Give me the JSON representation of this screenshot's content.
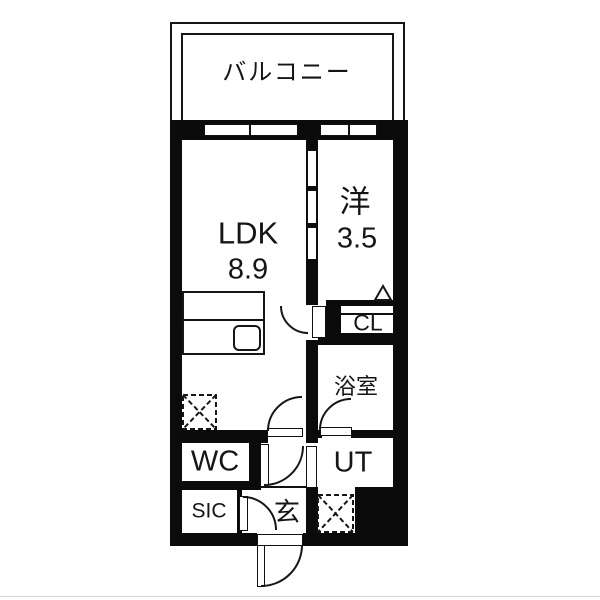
{
  "balcony": {
    "label": "バルコニー"
  },
  "rooms": {
    "ldk": {
      "label": "LDK",
      "size": "8.9"
    },
    "western_room": {
      "label": "洋",
      "size": "3.5"
    },
    "closet": {
      "label": "CL"
    },
    "bathroom": {
      "label": "浴室"
    },
    "toilet": {
      "label": "WC"
    },
    "utility": {
      "label": "UT"
    },
    "shoe_closet": {
      "label": "SIC"
    },
    "entrance": {
      "label": "玄"
    }
  },
  "marks": {
    "refrigerator_mark": "dashed-square-x",
    "washer_mark": "dashed-square-x",
    "closet_folding_door_mark": "triangle",
    "kitchen_sink": "rounded-rect"
  },
  "colors": {
    "wall": "#0b0b0b",
    "line": "#161616",
    "background": "#ffffff",
    "page_edge": "#d9d9d9"
  }
}
